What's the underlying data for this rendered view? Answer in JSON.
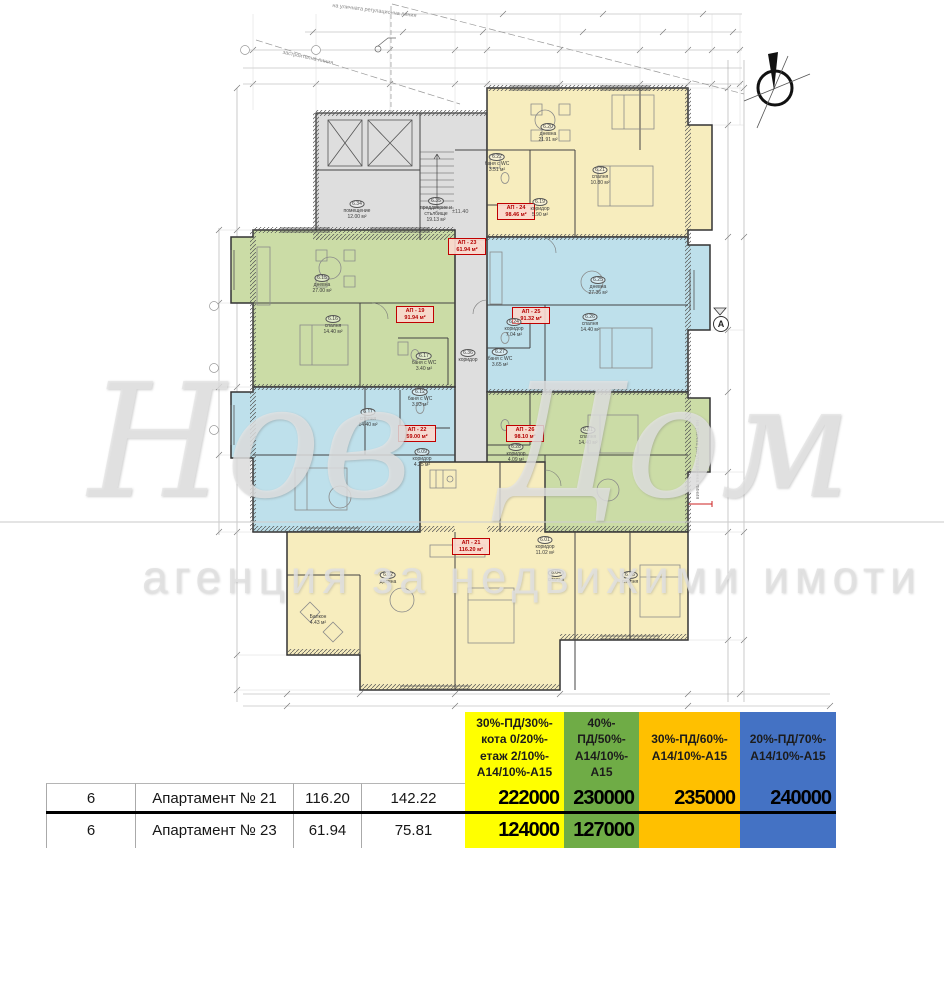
{
  "watermark": {
    "brand": "Нов Дом 1",
    "subtitle": "агенция за недвижими имоти"
  },
  "plan": {
    "colors": {
      "yellow": "#F7EDBE",
      "blue": "#BEE0EB",
      "green": "#CBDCA6",
      "gray": "#DEDEDE",
      "label_red": "#C00000"
    },
    "annotations": {
      "regulation_line_top": "на уличната регулационна линия",
      "construction_line": "застроителна линия",
      "regulation_line_right": "на улична регулационна линия",
      "section_marker": "А",
      "level_mid": "±11.40"
    },
    "apartments": [
      {
        "label": "АП - 19",
        "area": "91.94 м²"
      },
      {
        "label": "АП - 21",
        "area": "116.20 м²"
      },
      {
        "label": "АП - 22",
        "area": "59.00 м²"
      },
      {
        "label": "АП - 23",
        "area": "61.94 м²"
      },
      {
        "label": "АП - 24",
        "area": "98.46 м²"
      },
      {
        "label": "АП - 25",
        "area": "91.32 м²"
      },
      {
        "label": "АП - 26",
        "area": "98.10 м²"
      }
    ],
    "rooms": [
      {
        "num": "6.20",
        "name": "дневна",
        "area": "21.91 м²"
      },
      {
        "num": "6.21",
        "name": "спалня",
        "area": "10.80 м²"
      },
      {
        "num": "6.19",
        "name": "коридор",
        "area": "5.90 м²"
      },
      {
        "num": "6.22",
        "name": "баня с WC",
        "area": "3.51 м²"
      },
      {
        "num": "6.25",
        "name": "дневна",
        "area": "27.36 м²"
      },
      {
        "num": "6.26",
        "name": "спалня",
        "area": "14.40 м²"
      },
      {
        "num": "6.24",
        "name": "коридор",
        "area": "7.04 м²"
      },
      {
        "num": "6.27",
        "name": "баня с WC",
        "area": "3.65 м²"
      },
      {
        "num": "6.31",
        "name": "спалня",
        "area": "14.40 м²"
      },
      {
        "num": "6.28",
        "name": "коридор",
        "area": "4.09 м²"
      },
      {
        "num": "6.15",
        "name": "дневна",
        "area": "27.00 м²"
      },
      {
        "num": "6.16",
        "name": "спалня",
        "area": "14.40 м²"
      },
      {
        "num": "6.17",
        "name": "баня с WC",
        "area": "3.40 м²"
      },
      {
        "num": "6.11",
        "name": "спалня",
        "area": "14.40 м²"
      },
      {
        "num": "6.09",
        "name": "коридор",
        "area": "4.25 м²"
      },
      {
        "num": "6.34",
        "name": "помещение",
        "area": "12.00 м²"
      },
      {
        "num": "6.35",
        "name": "преддверие и стълбище",
        "area": "19.13 м²"
      },
      {
        "num": "6.01",
        "name": "коридор",
        "area": "11.02 м²"
      },
      {
        "num": "6.02",
        "name": "дневна",
        "area": ""
      },
      {
        "num": "6.04",
        "name": "спалня",
        "area": ""
      },
      {
        "num": "6.06",
        "name": "спалня",
        "area": ""
      },
      {
        "num": "",
        "name": "Балкон",
        "area": "4.43 м²"
      },
      {
        "num": "6.36",
        "name": "коридор",
        "area": ""
      },
      {
        "num": "6.12",
        "name": "баня с WC",
        "area": "3.93 м²"
      }
    ]
  },
  "table": {
    "colors": {
      "yellow": "#FFFF00",
      "green": "#6FAC46",
      "orange": "#FFC000",
      "blue": "#4472C4"
    },
    "plans": [
      {
        "label": "30%-ПД/30%-\nкота 0/20%-\nетаж 2/10%-\nА14/10%-А15"
      },
      {
        "label": "40%-\nПД/50%-\nА14/10%-\nА15"
      },
      {
        "label": "30%-ПД/60%-\nА14/10%-А15"
      },
      {
        "label": "20%-ПД/70%-\nА14/10%-А15"
      }
    ],
    "rows": [
      {
        "floor": "6",
        "name": "Апартамент № 21",
        "area_net": "116.20",
        "area_gross": "142.22",
        "prices": [
          "222000",
          "230000",
          "235000",
          "240000"
        ]
      },
      {
        "floor": "6",
        "name": "Апартамент № 23",
        "area_net": "61.94",
        "area_gross": "75.81",
        "prices": [
          "124000",
          "127000",
          "",
          ""
        ]
      }
    ]
  }
}
